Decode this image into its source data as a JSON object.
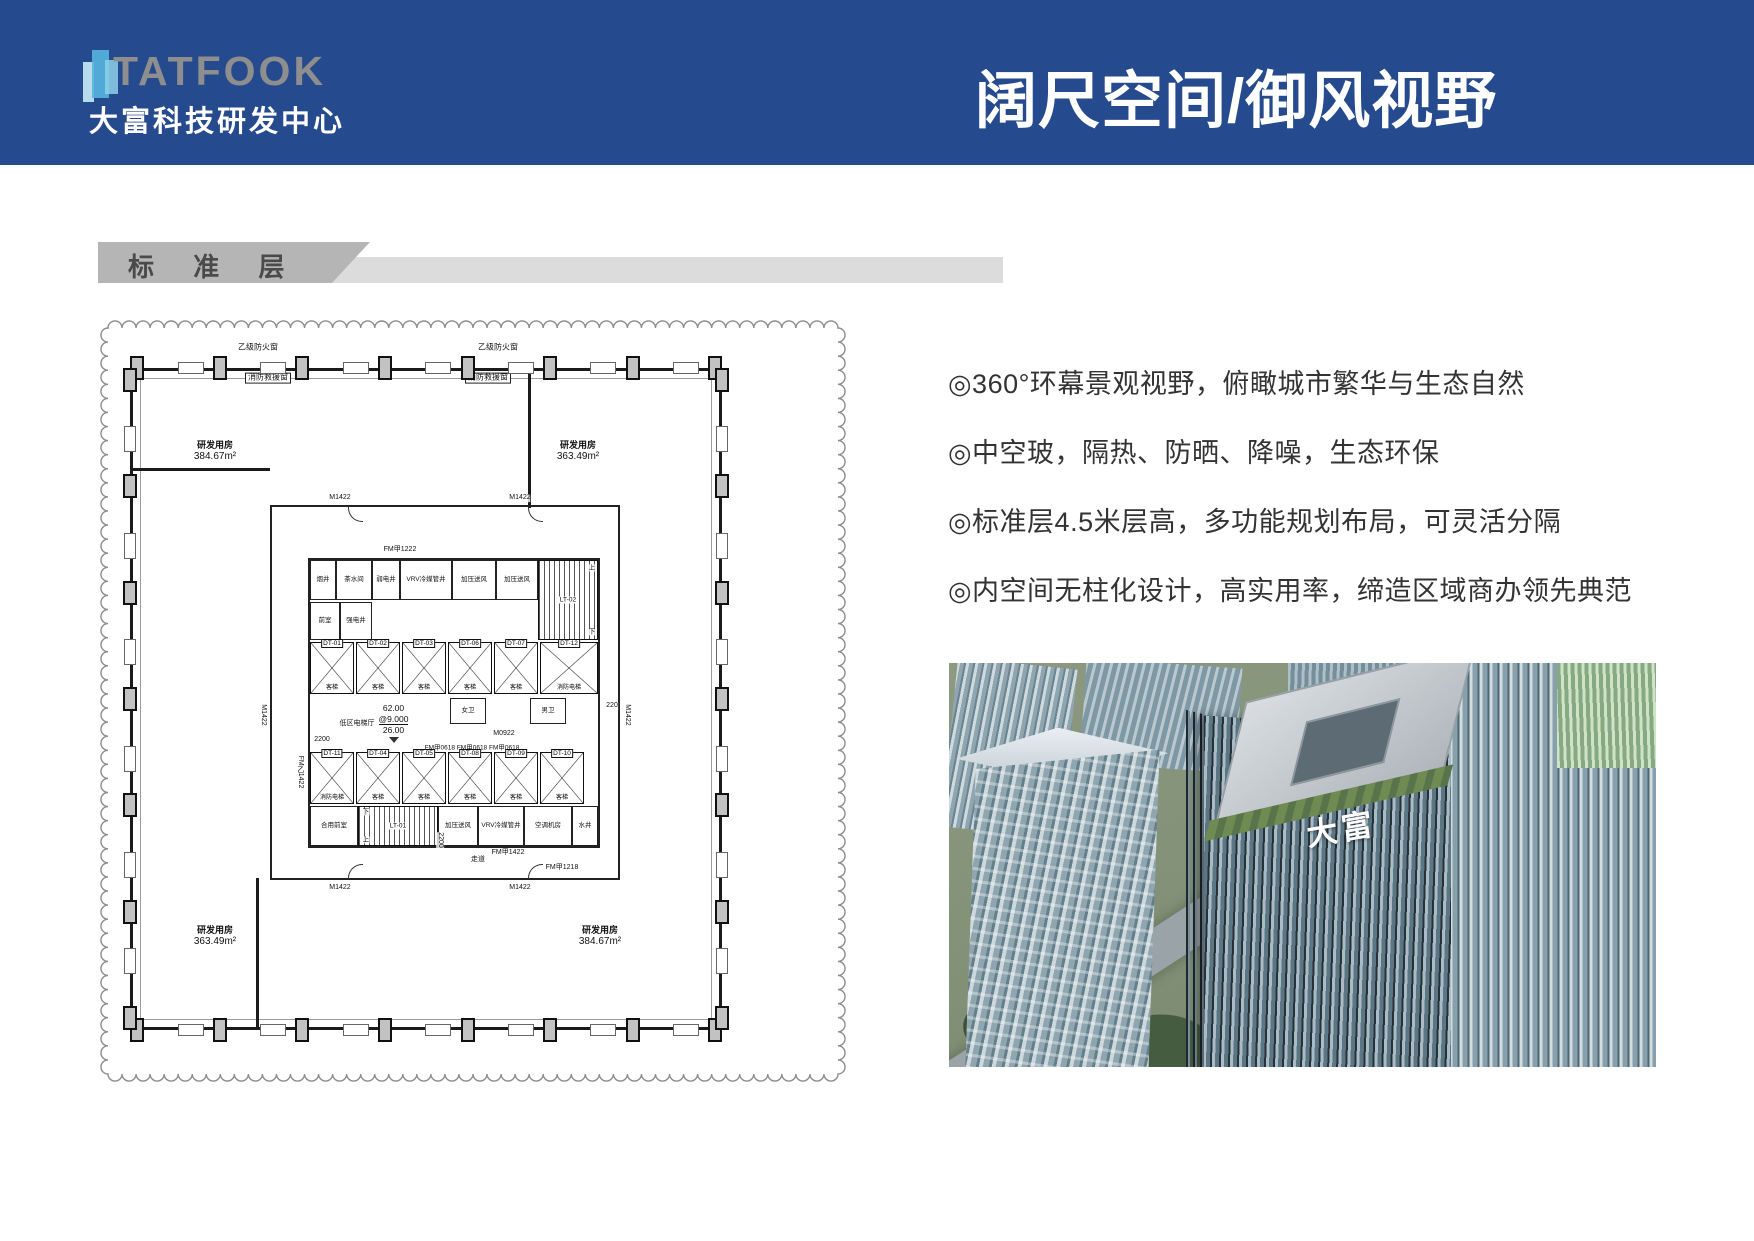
{
  "header": {
    "logo_text": "TATFOOK",
    "logo_subtitle": "大富科技研发中心",
    "title": "阔尺空间/御风视野"
  },
  "section": {
    "label": "标 准 层"
  },
  "bullets": [
    "◎360°环幕景观视野，俯瞰城市繁华与生态自然",
    "◎中空玻，隔热、防晒、降噪，生态环保",
    "◎标准层4.5米层高，多功能规划布局，可灵活分隔",
    "◎内空间无柱化设计，高实用率，缔造区域商办领先典范"
  ],
  "floorplan": {
    "rooms": [
      {
        "name": "研发用房",
        "area": "384.67m²"
      },
      {
        "name": "研发用房",
        "area": "363.49m²"
      },
      {
        "name": "研发用房",
        "area": "363.49m²"
      },
      {
        "name": "研发用房",
        "area": "384.67m²"
      }
    ],
    "window_label_left": "乙级防火窗",
    "window_label_right": "乙级防火窗",
    "rescue_label_left": "消防救援窗",
    "rescue_label_right": "消防救援窗",
    "door_labels": {
      "m1422": "M1422",
      "fm1222": "FM甲1222",
      "fm1218": "FM甲1218",
      "fmb1422": "FM乙1422",
      "fm1422": "FM甲1422",
      "m0922": "M0922",
      "fm0618_row": "FM甲0618 FM甲0618 FM甲0618"
    },
    "dims": {
      "d2200": "2200",
      "d2200b": "2200",
      "d220": "220"
    },
    "lobby": {
      "name": "低区电梯厅",
      "n1": "62.00",
      "n2": "@9.000",
      "n3": "26.00"
    },
    "corridor_label": "走道",
    "core_top_cells": [
      "烟井",
      "茶水间",
      "弱电井",
      "VRV冷媒管井",
      "加压送风",
      "加压送风"
    ],
    "core_mid_cells": [
      "前室",
      "强电井"
    ],
    "toilets": [
      "女卫",
      "男卫"
    ],
    "core_bottom_cells": [
      "合用前室",
      "加压送风",
      "VRV冷媒管井",
      "空调机房",
      "水井"
    ],
    "lifts_top": [
      {
        "id": "DT-01",
        "sub": "客梯"
      },
      {
        "id": "DT-02",
        "sub": "客梯"
      },
      {
        "id": "DT-03",
        "sub": "客梯"
      },
      {
        "id": "DT-06",
        "sub": "客梯"
      },
      {
        "id": "DT-07",
        "sub": "客梯"
      },
      {
        "id": "DT-12",
        "sub": "消防电梯"
      }
    ],
    "lifts_bottom": [
      {
        "id": "DT-11",
        "sub": "消防电梯"
      },
      {
        "id": "DT-04",
        "sub": "客梯"
      },
      {
        "id": "DT-05",
        "sub": "客梯"
      },
      {
        "id": "DT-08",
        "sub": "客梯"
      },
      {
        "id": "DT-09",
        "sub": "客梯"
      },
      {
        "id": "DT-10",
        "sub": "客梯"
      }
    ],
    "stairs": [
      "LT-02",
      "LT-01"
    ],
    "up": "上",
    "down": "下"
  },
  "photo": {
    "building_sign": "大富"
  },
  "colors": {
    "header_blue": "#264a8e",
    "banner_dark": "#b5b5b5",
    "banner_light": "#dcdcdc",
    "logo_gray": "#8e8e8e",
    "text_dark": "#333333"
  }
}
